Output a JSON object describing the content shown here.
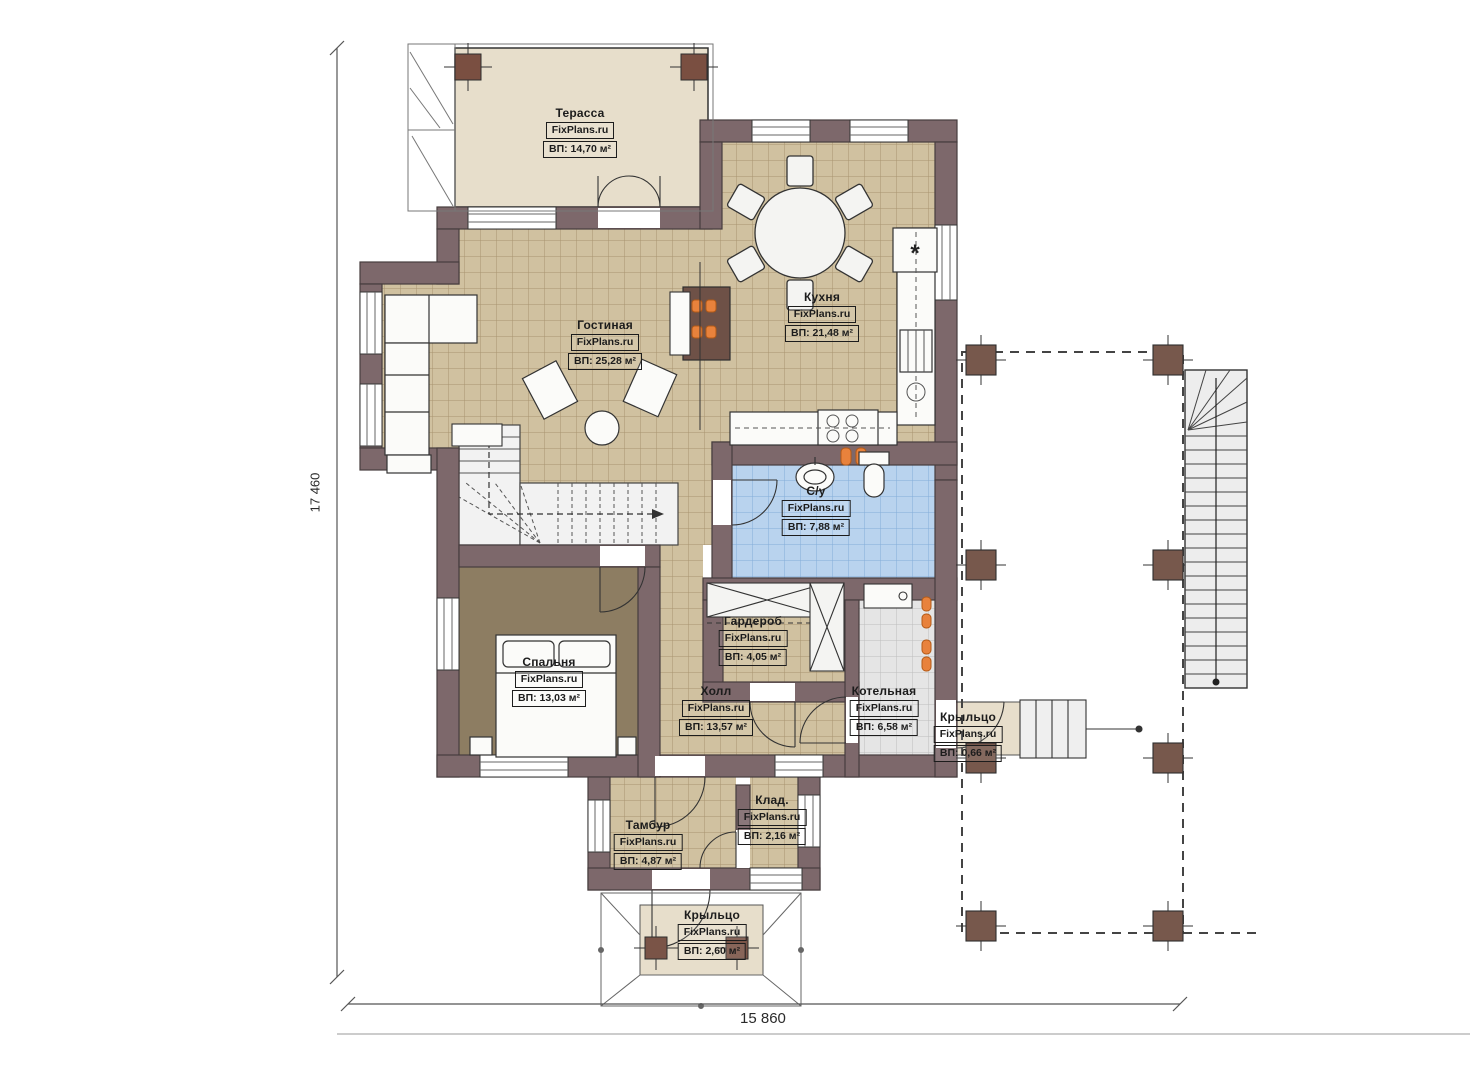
{
  "brand": "FixPlans.ru",
  "dimensions": {
    "vertical": "17 460",
    "horizontal": "15 860"
  },
  "symbols": {
    "chimney": "*"
  },
  "rooms": [
    {
      "id": "terrace",
      "name": "Терасса",
      "area": "ВП: 14,70 м²"
    },
    {
      "id": "living",
      "name": "Гостиная",
      "area": "ВП: 25,28 м²"
    },
    {
      "id": "kitchen",
      "name": "Кухня",
      "area": "ВП: 21,48 м²"
    },
    {
      "id": "bathroom",
      "name": "С/у",
      "area": "ВП: 7,88 м²"
    },
    {
      "id": "bedroom",
      "name": "Спальня",
      "area": "ВП: 13,03 м²"
    },
    {
      "id": "wardrobe",
      "name": "Гардероб",
      "area": "ВП: 4,05 м²"
    },
    {
      "id": "hall",
      "name": "Холл",
      "area": "ВП: 13,57 м²"
    },
    {
      "id": "boiler",
      "name": "Котельная",
      "area": "ВП: 6,58 м²"
    },
    {
      "id": "porch-right",
      "name": "Крыльцо",
      "area": "ВП: 0,66 м²"
    },
    {
      "id": "tambour",
      "name": "Тамбур",
      "area": "ВП: 4,87 м²"
    },
    {
      "id": "storage",
      "name": "Клад.",
      "area": "ВП: 2,16 м²"
    },
    {
      "id": "porch-front",
      "name": "Крыльцо",
      "area": "ВП: 2,60 м²"
    }
  ],
  "colors": {
    "wall": "#7d686b",
    "tile_floor": "#d0c1a0",
    "terrace_floor": "#e7decb",
    "bedroom_floor": "#8d7d62",
    "bathroom_floor": "#b9d3ee",
    "boiler_floor": "#e5e5e5",
    "column_brown": "#7a5447",
    "radiator_orange": "#e8823c"
  }
}
